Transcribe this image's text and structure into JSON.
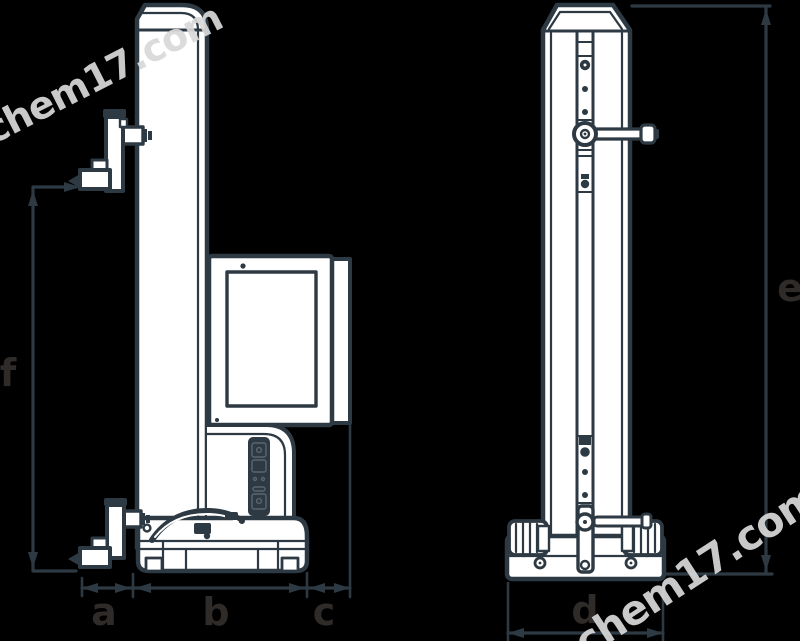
{
  "page": {
    "description": "Technical dimension drawing of a height gauge / measuring column instrument, two orthographic views (side view and front view) with dimension callouts",
    "background_color": "#000000"
  },
  "drawing": {
    "line_color": "#2d3943",
    "fill_color": "#ffffff",
    "label_color": "#2e2b29",
    "watermark_color": "#d9d9d9",
    "dimension_labels": {
      "a": "a",
      "b": "b",
      "c": "c",
      "d": "d",
      "e": "e",
      "f": "f"
    },
    "watermarks": {
      "top_left": "chem17.com",
      "bottom_right": "chem17.com"
    }
  }
}
